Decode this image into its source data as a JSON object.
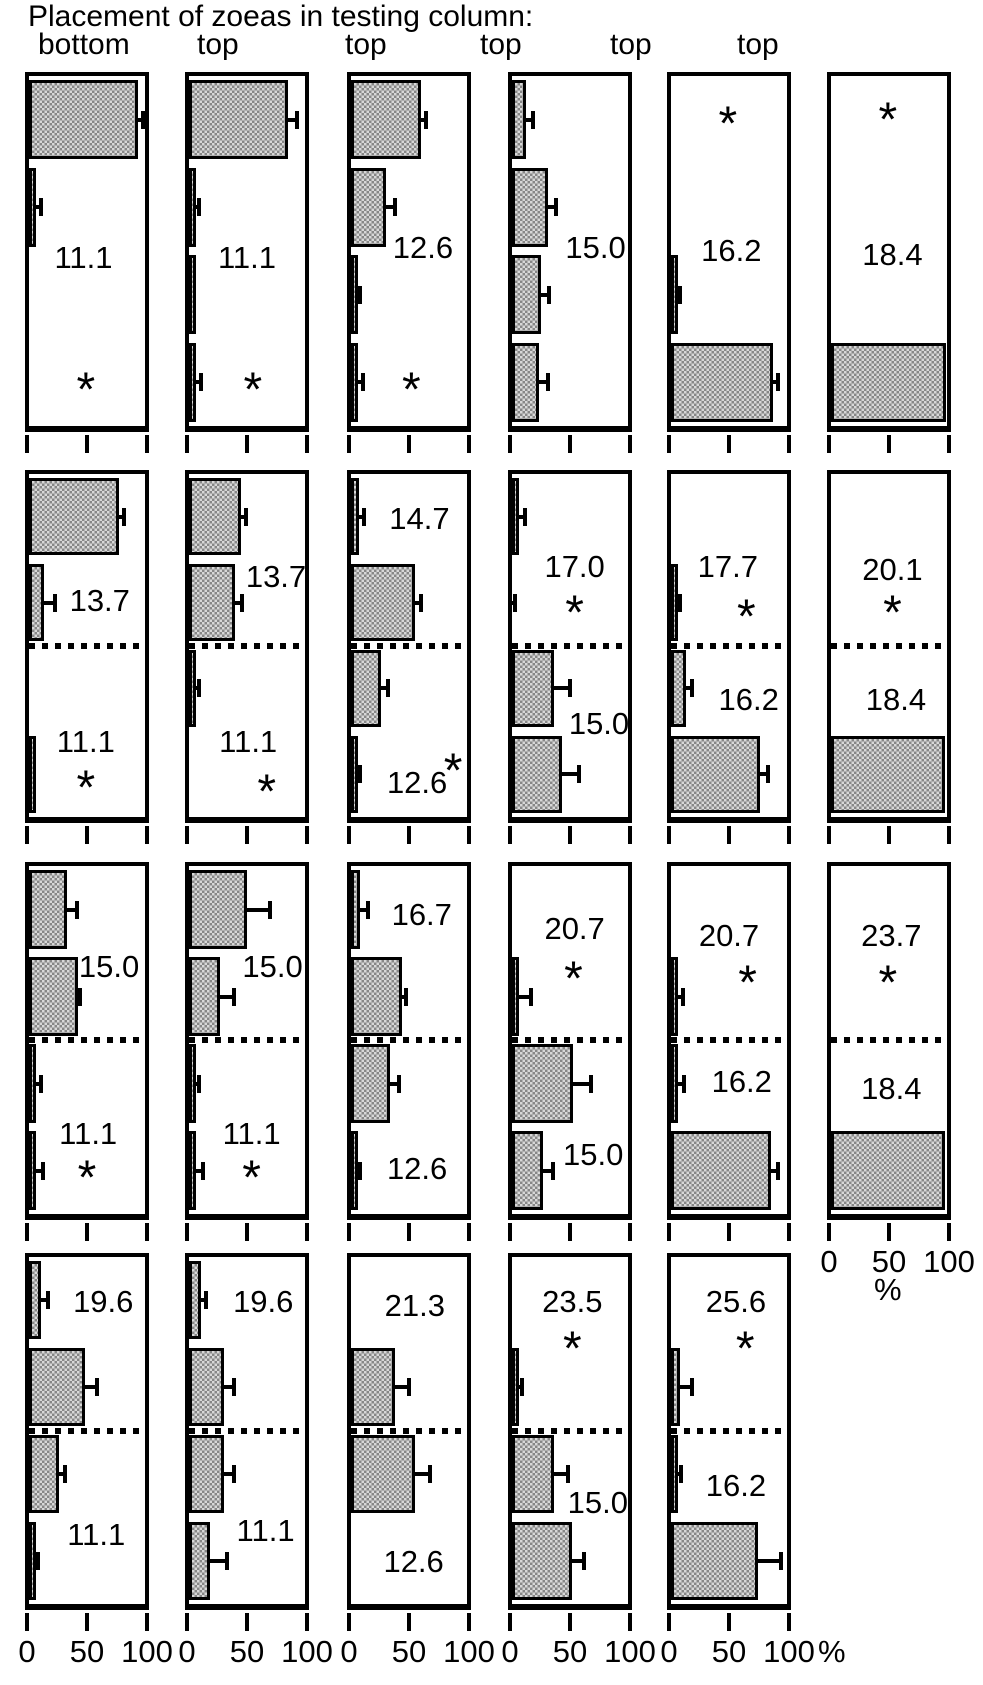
{
  "title": "Placement of zoeas in testing column:",
  "column_headers": [
    "bottom",
    "top",
    "top",
    "top",
    "top",
    "top"
  ],
  "chart_data": {
    "type": "bar",
    "orientation": "horizontal",
    "x_axis": {
      "tick_labels": [
        "0",
        "50",
        "100"
      ],
      "range": [
        0,
        100
      ],
      "unit": "%"
    },
    "bars_per_panel": 4,
    "significance_marker": "*",
    "panels": [
      {
        "row": 1,
        "col": 1,
        "stratified": false,
        "show_x_labels": false,
        "temperature_labels": [
          {
            "text": "11.1",
            "x": 47,
            "y": 52
          }
        ],
        "asterisks": [
          {
            "x": 49,
            "y": 87
          }
        ],
        "bars": [
          {
            "v": 94,
            "e": 4
          },
          {
            "v": 2,
            "e": 4
          },
          {
            "v": 0,
            "e": 0
          },
          {
            "v": 0,
            "e": 0
          }
        ]
      },
      {
        "row": 1,
        "col": 2,
        "stratified": false,
        "show_x_labels": false,
        "temperature_labels": [
          {
            "text": "11.1",
            "x": 50,
            "y": 52
          }
        ],
        "asterisks": [
          {
            "x": 55,
            "y": 87
          }
        ],
        "bars": [
          {
            "v": 85,
            "e": 8
          },
          {
            "v": 1,
            "e": 3
          },
          {
            "v": 1,
            "e": 0
          },
          {
            "v": 2,
            "e": 4
          }
        ]
      },
      {
        "row": 1,
        "col": 3,
        "stratified": false,
        "show_x_labels": false,
        "temperature_labels": [
          {
            "text": "12.6",
            "x": 62,
            "y": 49
          }
        ],
        "asterisks": [
          {
            "x": 52,
            "y": 87
          }
        ],
        "bars": [
          {
            "v": 60,
            "e": 5
          },
          {
            "v": 30,
            "e": 8
          },
          {
            "v": 1,
            "e": 2
          },
          {
            "v": 3,
            "e": 4
          }
        ]
      },
      {
        "row": 1,
        "col": 4,
        "stratified": false,
        "show_x_labels": false,
        "temperature_labels": [
          {
            "text": "15.0",
            "x": 72,
            "y": 49
          }
        ],
        "asterisks": [],
        "bars": [
          {
            "v": 12,
            "e": 6
          },
          {
            "v": 31,
            "e": 7
          },
          {
            "v": 25,
            "e": 7
          },
          {
            "v": 23,
            "e": 8
          }
        ]
      },
      {
        "row": 1,
        "col": 5,
        "stratified": false,
        "show_x_labels": false,
        "temperature_labels": [
          {
            "text": "16.2",
            "x": 52,
            "y": 50
          }
        ],
        "asterisks": [
          {
            "x": 49,
            "y": 11
          }
        ],
        "bars": [
          {
            "v": 0,
            "e": 0
          },
          {
            "v": 0,
            "e": 0
          },
          {
            "v": 2,
            "e": 2
          },
          {
            "v": 88,
            "e": 4
          }
        ]
      },
      {
        "row": 1,
        "col": 6,
        "stratified": false,
        "show_x_labels": false,
        "temperature_labels": [
          {
            "text": "18.4",
            "x": 53,
            "y": 51
          }
        ],
        "asterisks": [
          {
            "x": 49,
            "y": 10
          }
        ],
        "bars": [
          {
            "v": 0,
            "e": 0
          },
          {
            "v": 0,
            "e": 0
          },
          {
            "v": 0,
            "e": 0
          },
          {
            "v": 99,
            "e": 0
          }
        ]
      },
      {
        "row": 2,
        "col": 1,
        "stratified": true,
        "show_x_labels": false,
        "temperature_labels": [
          {
            "text": "13.7",
            "x": 61,
            "y": 37
          },
          {
            "text": "11.1",
            "x": 49,
            "y": 78
          }
        ],
        "asterisks": [
          {
            "x": 49,
            "y": 89
          }
        ],
        "bars": [
          {
            "v": 78,
            "e": 4
          },
          {
            "v": 13,
            "e": 9
          },
          {
            "v": 0,
            "e": 0
          },
          {
            "v": 1,
            "e": 0
          }
        ]
      },
      {
        "row": 2,
        "col": 2,
        "stratified": true,
        "show_x_labels": false,
        "temperature_labels": [
          {
            "text": "13.7",
            "x": 75,
            "y": 30
          },
          {
            "text": "11.1",
            "x": 51,
            "y": 78
          }
        ],
        "asterisks": [
          {
            "x": 67,
            "y": 90
          }
        ],
        "bars": [
          {
            "v": 45,
            "e": 4
          },
          {
            "v": 40,
            "e": 6
          },
          {
            "v": 6,
            "e": 3
          },
          {
            "v": 0,
            "e": 0
          }
        ]
      },
      {
        "row": 2,
        "col": 3,
        "stratified": true,
        "show_x_labels": false,
        "temperature_labels": [
          {
            "text": "14.7",
            "x": 59,
            "y": 13
          },
          {
            "text": "12.6",
            "x": 57,
            "y": 90
          }
        ],
        "asterisks": [
          {
            "x": 88,
            "y": 84
          }
        ],
        "bars": [
          {
            "v": 7,
            "e": 4
          },
          {
            "v": 55,
            "e": 5
          },
          {
            "v": 26,
            "e": 6
          },
          {
            "v": 1,
            "e": 2
          }
        ]
      },
      {
        "row": 2,
        "col": 4,
        "stratified": true,
        "show_x_labels": false,
        "temperature_labels": [
          {
            "text": "17.0",
            "x": 54,
            "y": 27
          },
          {
            "text": "15.0",
            "x": 75,
            "y": 73
          }
        ],
        "asterisks": [
          {
            "x": 54,
            "y": 38
          }
        ],
        "bars": [
          {
            "v": 6,
            "e": 5
          },
          {
            "v": 0,
            "e": 3
          },
          {
            "v": 36,
            "e": 14
          },
          {
            "v": 43,
            "e": 15
          }
        ]
      },
      {
        "row": 2,
        "col": 5,
        "stratified": true,
        "show_x_labels": false,
        "temperature_labels": [
          {
            "text": "17.7",
            "x": 49,
            "y": 27
          },
          {
            "text": "16.2",
            "x": 67,
            "y": 66
          }
        ],
        "asterisks": [
          {
            "x": 65,
            "y": 39
          }
        ],
        "bars": [
          {
            "v": 0,
            "e": 0
          },
          {
            "v": 1,
            "e": 2
          },
          {
            "v": 13,
            "e": 5
          },
          {
            "v": 77,
            "e": 7
          }
        ]
      },
      {
        "row": 2,
        "col": 6,
        "stratified": true,
        "show_x_labels": false,
        "temperature_labels": [
          {
            "text": "20.1",
            "x": 53,
            "y": 28
          },
          {
            "text": "18.4",
            "x": 56,
            "y": 66
          }
        ],
        "asterisks": [
          {
            "x": 53,
            "y": 38
          }
        ],
        "bars": [
          {
            "v": 0,
            "e": 0
          },
          {
            "v": 0,
            "e": 0
          },
          {
            "v": 0,
            "e": 0
          },
          {
            "v": 98,
            "e": 0
          }
        ]
      },
      {
        "row": 3,
        "col": 1,
        "stratified": true,
        "show_x_labels": false,
        "temperature_labels": [
          {
            "text": "15.0",
            "x": 69,
            "y": 29
          },
          {
            "text": "11.1",
            "x": 51,
            "y": 77
          }
        ],
        "asterisks": [
          {
            "x": 50,
            "y": 87
          }
        ],
        "bars": [
          {
            "v": 33,
            "e": 8
          },
          {
            "v": 42,
            "e": 2
          },
          {
            "v": 3,
            "e": 4
          },
          {
            "v": 5,
            "e": 6
          }
        ]
      },
      {
        "row": 3,
        "col": 2,
        "stratified": true,
        "show_x_labels": false,
        "temperature_labels": [
          {
            "text": "15.0",
            "x": 72,
            "y": 29
          },
          {
            "text": "11.1",
            "x": 54,
            "y": 77
          }
        ],
        "asterisks": [
          {
            "x": 54,
            "y": 87
          }
        ],
        "bars": [
          {
            "v": 50,
            "e": 20
          },
          {
            "v": 27,
            "e": 12
          },
          {
            "v": 5,
            "e": 3
          },
          {
            "v": 4,
            "e": 6
          }
        ]
      },
      {
        "row": 3,
        "col": 3,
        "stratified": true,
        "show_x_labels": false,
        "temperature_labels": [
          {
            "text": "16.7",
            "x": 61,
            "y": 14
          },
          {
            "text": "12.6",
            "x": 57,
            "y": 87
          }
        ],
        "asterisks": [],
        "bars": [
          {
            "v": 8,
            "e": 7
          },
          {
            "v": 44,
            "e": 3
          },
          {
            "v": 34,
            "e": 7
          },
          {
            "v": 1,
            "e": 2
          }
        ]
      },
      {
        "row": 3,
        "col": 4,
        "stratified": true,
        "show_x_labels": false,
        "temperature_labels": [
          {
            "text": "20.7",
            "x": 54,
            "y": 18
          },
          {
            "text": "15.0",
            "x": 70,
            "y": 83
          }
        ],
        "asterisks": [
          {
            "x": 53,
            "y": 30
          }
        ],
        "bars": [
          {
            "v": 0,
            "e": 0
          },
          {
            "v": 3,
            "e": 10
          },
          {
            "v": 53,
            "e": 15
          },
          {
            "v": 27,
            "e": 8
          }
        ]
      },
      {
        "row": 3,
        "col": 5,
        "stratified": true,
        "show_x_labels": false,
        "temperature_labels": [
          {
            "text": "20.7",
            "x": 50,
            "y": 20
          },
          {
            "text": "16.2",
            "x": 61,
            "y": 62
          }
        ],
        "asterisks": [
          {
            "x": 66,
            "y": 31
          }
        ],
        "bars": [
          {
            "v": 0,
            "e": 0
          },
          {
            "v": 2,
            "e": 4
          },
          {
            "v": 2,
            "e": 5
          },
          {
            "v": 86,
            "e": 6
          }
        ]
      },
      {
        "row": 3,
        "col": 6,
        "stratified": true,
        "show_x_labels": true,
        "temperature_labels": [
          {
            "text": "23.7",
            "x": 52,
            "y": 20
          },
          {
            "text": "18.4",
            "x": 52,
            "y": 64
          }
        ],
        "asterisks": [
          {
            "x": 49,
            "y": 31
          }
        ],
        "bars": [
          {
            "v": 0,
            "e": 0
          },
          {
            "v": 0,
            "e": 0
          },
          {
            "v": 0,
            "e": 0
          },
          {
            "v": 98,
            "e": 0
          }
        ]
      },
      {
        "row": 4,
        "col": 1,
        "stratified": true,
        "show_x_labels": true,
        "temperature_labels": [
          {
            "text": "19.6",
            "x": 64,
            "y": 13
          },
          {
            "text": "11.1",
            "x": 58,
            "y": 80
          }
        ],
        "asterisks": [],
        "bars": [
          {
            "v": 10,
            "e": 6
          },
          {
            "v": 48,
            "e": 11
          },
          {
            "v": 26,
            "e": 5
          },
          {
            "v": 1,
            "e": 2
          }
        ]
      },
      {
        "row": 4,
        "col": 2,
        "stratified": true,
        "show_x_labels": true,
        "temperature_labels": [
          {
            "text": "19.6",
            "x": 64,
            "y": 13
          },
          {
            "text": "11.1",
            "x": 66,
            "y": 79
          }
        ],
        "asterisks": [],
        "bars": [
          {
            "v": 10,
            "e": 5
          },
          {
            "v": 30,
            "e": 9
          },
          {
            "v": 30,
            "e": 9
          },
          {
            "v": 18,
            "e": 15
          }
        ]
      },
      {
        "row": 4,
        "col": 3,
        "stratified": true,
        "show_x_labels": true,
        "temperature_labels": [
          {
            "text": "21.3",
            "x": 55,
            "y": 14
          },
          {
            "text": "12.6",
            "x": 54,
            "y": 88
          }
        ],
        "asterisks": [],
        "bars": [
          {
            "v": 0,
            "e": 0
          },
          {
            "v": 38,
            "e": 12
          },
          {
            "v": 55,
            "e": 13
          },
          {
            "v": 0,
            "e": 0
          }
        ]
      },
      {
        "row": 4,
        "col": 4,
        "stratified": true,
        "show_x_labels": true,
        "temperature_labels": [
          {
            "text": "23.5",
            "x": 52,
            "y": 13
          },
          {
            "text": "15.0",
            "x": 74,
            "y": 71
          }
        ],
        "asterisks": [
          {
            "x": 52,
            "y": 24
          }
        ],
        "bars": [
          {
            "v": 0,
            "e": 0
          },
          {
            "v": 5,
            "e": 3
          },
          {
            "v": 36,
            "e": 12
          },
          {
            "v": 52,
            "e": 10
          }
        ]
      },
      {
        "row": 4,
        "col": 5,
        "stratified": true,
        "show_x_labels": true,
        "temperature_labels": [
          {
            "text": "25.6",
            "x": 56,
            "y": 13
          },
          {
            "text": "16.2",
            "x": 56,
            "y": 66
          }
        ],
        "asterisks": [
          {
            "x": 64,
            "y": 24
          }
        ],
        "bars": [
          {
            "v": 0,
            "e": 0
          },
          {
            "v": 8,
            "e": 10
          },
          {
            "v": 1,
            "e": 3
          },
          {
            "v": 75,
            "e": 20
          }
        ]
      }
    ]
  }
}
